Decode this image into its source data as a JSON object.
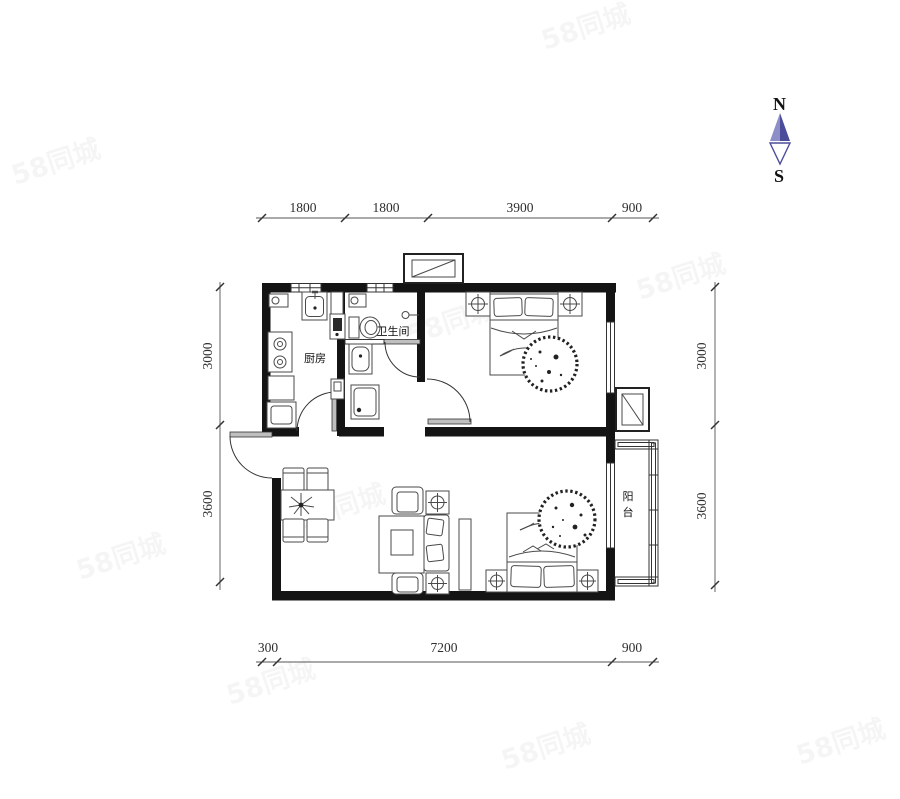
{
  "watermark": {
    "text": "58同城"
  },
  "compass": {
    "north_label": "N",
    "south_label": "S"
  },
  "rooms": {
    "kitchen": "厨房",
    "bathroom": "卫生间",
    "balcony_chars": [
      "阳",
      "台"
    ]
  },
  "dimensions": {
    "top": [
      "1800",
      "1800",
      "3900",
      "900"
    ],
    "left": [
      "3000",
      "3600"
    ],
    "right": [
      "3000",
      "3600"
    ],
    "bottom": [
      "300",
      "7200",
      "900"
    ]
  },
  "colors": {
    "wall": "#141414",
    "line": "#4a4a4a",
    "dim_text": "#2e2e2e",
    "compass_blue": "#5355a2",
    "compass_blue_light": "#8c8ec7"
  }
}
